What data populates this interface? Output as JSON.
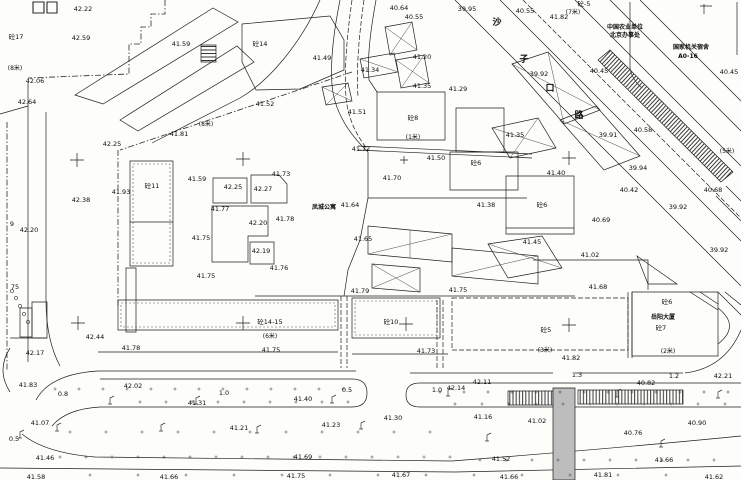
{
  "map": {
    "type": "topographic-site-plan",
    "colors": {
      "background": "#fdfdfa",
      "line": "#1e1e1e",
      "hatch": "#3a3a3a",
      "median_fill": "#bdbdbd"
    },
    "street_name_chars": [
      {
        "x": 497,
        "y": 25,
        "t": "沙"
      },
      {
        "x": 524,
        "y": 62,
        "t": "子"
      },
      {
        "x": 550,
        "y": 91,
        "t": "口"
      },
      {
        "x": 579,
        "y": 118,
        "t": "路"
      }
    ],
    "place_names": [
      {
        "x": 324,
        "y": 209,
        "t": "凤城公寓"
      },
      {
        "x": 663,
        "y": 319,
        "t": "岳阳大厦"
      },
      {
        "x": 625,
        "y": 29,
        "t": "中国农业单位"
      },
      {
        "x": 625,
        "y": 37,
        "t": "北京办事处"
      },
      {
        "x": 691,
        "y": 49,
        "t": "国家机关宿舍"
      },
      {
        "x": 688,
        "y": 58,
        "t": "A0-16"
      }
    ],
    "floor_labels": [
      {
        "x": 16,
        "y": 39,
        "t": "砼17"
      },
      {
        "x": 260,
        "y": 46,
        "t": "砼14"
      },
      {
        "x": 584,
        "y": 6,
        "t": "砼-5"
      },
      {
        "x": 152,
        "y": 188,
        "t": "砼11"
      },
      {
        "x": 413,
        "y": 120,
        "t": "砼8"
      },
      {
        "x": 476,
        "y": 165,
        "t": "砼6"
      },
      {
        "x": 542,
        "y": 207,
        "t": "砼6"
      },
      {
        "x": 667,
        "y": 304,
        "t": "砼6"
      },
      {
        "x": 270,
        "y": 324,
        "t": "砼14-15"
      },
      {
        "x": 391,
        "y": 324,
        "t": "砼10"
      },
      {
        "x": 546,
        "y": 332,
        "t": "砼5"
      },
      {
        "x": 661,
        "y": 330,
        "t": "砼7"
      }
    ],
    "road_widths": [
      {
        "x": 15,
        "y": 70,
        "t": "(8米)"
      },
      {
        "x": 206,
        "y": 126,
        "t": "(8米)"
      },
      {
        "x": 573,
        "y": 14,
        "t": "(7米)"
      },
      {
        "x": 413,
        "y": 139,
        "t": "(1米)"
      },
      {
        "x": 727,
        "y": 153,
        "t": "(5米)"
      },
      {
        "x": 270,
        "y": 338,
        "t": "(6米)"
      },
      {
        "x": 545,
        "y": 352,
        "t": "(3米)"
      },
      {
        "x": 668,
        "y": 353,
        "t": "(2米)"
      }
    ],
    "spot_elevations": [
      {
        "x": 83,
        "y": 11,
        "t": "42.22"
      },
      {
        "x": 81,
        "y": 40,
        "t": "42.59"
      },
      {
        "x": 35,
        "y": 83,
        "t": "42.06"
      },
      {
        "x": 27,
        "y": 104,
        "t": "42.64"
      },
      {
        "x": 181,
        "y": 46,
        "t": "41.59"
      },
      {
        "x": 265,
        "y": 106,
        "t": "41.52"
      },
      {
        "x": 322,
        "y": 60,
        "t": "41.49"
      },
      {
        "x": 357,
        "y": 114,
        "t": "41.51"
      },
      {
        "x": 370,
        "y": 72,
        "t": "41.34"
      },
      {
        "x": 422,
        "y": 59,
        "t": "41.20"
      },
      {
        "x": 399,
        "y": 10,
        "t": "40.64"
      },
      {
        "x": 414,
        "y": 19,
        "t": "40.55"
      },
      {
        "x": 467,
        "y": 11,
        "t": "39.95"
      },
      {
        "x": 422,
        "y": 88,
        "t": "41.35"
      },
      {
        "x": 458,
        "y": 91,
        "t": "41.29"
      },
      {
        "x": 525,
        "y": 13,
        "t": "40.55"
      },
      {
        "x": 559,
        "y": 19,
        "t": "41.82"
      },
      {
        "x": 539,
        "y": 76,
        "t": "39.92"
      },
      {
        "x": 599,
        "y": 73,
        "t": "40.45"
      },
      {
        "x": 729,
        "y": 74,
        "t": "40.45"
      },
      {
        "x": 112,
        "y": 146,
        "t": "42.25"
      },
      {
        "x": 179,
        "y": 136,
        "t": "41.81"
      },
      {
        "x": 121,
        "y": 194,
        "t": "41.93"
      },
      {
        "x": 197,
        "y": 181,
        "t": "41.59"
      },
      {
        "x": 81,
        "y": 202,
        "t": "42.38"
      },
      {
        "x": 233,
        "y": 189,
        "t": "42.25"
      },
      {
        "x": 263,
        "y": 191,
        "t": "42.27"
      },
      {
        "x": 281,
        "y": 176,
        "t": "41.73"
      },
      {
        "x": 220,
        "y": 211,
        "t": "41.77"
      },
      {
        "x": 258,
        "y": 225,
        "t": "42.20"
      },
      {
        "x": 285,
        "y": 221,
        "t": "41.78"
      },
      {
        "x": 201,
        "y": 240,
        "t": "41.75"
      },
      {
        "x": 261,
        "y": 253,
        "t": "42.19"
      },
      {
        "x": 279,
        "y": 270,
        "t": "41.76"
      },
      {
        "x": 206,
        "y": 278,
        "t": "41.75"
      },
      {
        "x": 29,
        "y": 232,
        "t": "42.20"
      },
      {
        "x": 12,
        "y": 226,
        "t": "9"
      },
      {
        "x": 15,
        "y": 289,
        "t": "75"
      },
      {
        "x": 35,
        "y": 355,
        "t": "42.17"
      },
      {
        "x": 95,
        "y": 339,
        "t": "42.44"
      },
      {
        "x": 131,
        "y": 350,
        "t": "41.78"
      },
      {
        "x": 361,
        "y": 151,
        "t": "41.72"
      },
      {
        "x": 436,
        "y": 160,
        "t": "41.50"
      },
      {
        "x": 392,
        "y": 180,
        "t": "41.70"
      },
      {
        "x": 350,
        "y": 207,
        "t": "41.64"
      },
      {
        "x": 363,
        "y": 241,
        "t": "41.65"
      },
      {
        "x": 486,
        "y": 207,
        "t": "41.38"
      },
      {
        "x": 515,
        "y": 137,
        "t": "41.35"
      },
      {
        "x": 608,
        "y": 137,
        "t": "39.91"
      },
      {
        "x": 643,
        "y": 132,
        "t": "40.58"
      },
      {
        "x": 638,
        "y": 170,
        "t": "39.94"
      },
      {
        "x": 556,
        "y": 175,
        "t": "41.40"
      },
      {
        "x": 629,
        "y": 192,
        "t": "40.42"
      },
      {
        "x": 713,
        "y": 192,
        "t": "40.68"
      },
      {
        "x": 678,
        "y": 209,
        "t": "39.92"
      },
      {
        "x": 601,
        "y": 222,
        "t": "40.69"
      },
      {
        "x": 532,
        "y": 244,
        "t": "41.45"
      },
      {
        "x": 590,
        "y": 257,
        "t": "41.02"
      },
      {
        "x": 598,
        "y": 289,
        "t": "41.68"
      },
      {
        "x": 719,
        "y": 252,
        "t": "39.92"
      },
      {
        "x": 571,
        "y": 360,
        "t": "41.82"
      },
      {
        "x": 271,
        "y": 352,
        "t": "41.75"
      },
      {
        "x": 426,
        "y": 353,
        "t": "41.73"
      },
      {
        "x": 360,
        "y": 293,
        "t": "41.79"
      },
      {
        "x": 458,
        "y": 292,
        "t": "41.75"
      },
      {
        "x": 28,
        "y": 387,
        "t": "41.83"
      },
      {
        "x": 63,
        "y": 396,
        "t": "0.8"
      },
      {
        "x": 133,
        "y": 388,
        "t": "42.02"
      },
      {
        "x": 224,
        "y": 395,
        "t": "1.0"
      },
      {
        "x": 197,
        "y": 405,
        "t": "41.31"
      },
      {
        "x": 40,
        "y": 425,
        "t": "41.07"
      },
      {
        "x": 239,
        "y": 430,
        "t": "41.21"
      },
      {
        "x": 14,
        "y": 441,
        "t": "0.5"
      },
      {
        "x": 45,
        "y": 460,
        "t": "41.46"
      },
      {
        "x": 36,
        "y": 479,
        "t": "41.58"
      },
      {
        "x": 169,
        "y": 479,
        "t": "41.66"
      },
      {
        "x": 347,
        "y": 392,
        "t": "0.5"
      },
      {
        "x": 303,
        "y": 401,
        "t": "41.40"
      },
      {
        "x": 437,
        "y": 392,
        "t": "1.0"
      },
      {
        "x": 456,
        "y": 390,
        "t": "42.14"
      },
      {
        "x": 482,
        "y": 384,
        "t": "42.11"
      },
      {
        "x": 393,
        "y": 420,
        "t": "41.30"
      },
      {
        "x": 483,
        "y": 419,
        "t": "41.16"
      },
      {
        "x": 331,
        "y": 427,
        "t": "41.23"
      },
      {
        "x": 303,
        "y": 459,
        "t": "41.69"
      },
      {
        "x": 296,
        "y": 478,
        "t": "41.75"
      },
      {
        "x": 401,
        "y": 477,
        "t": "41.67"
      },
      {
        "x": 577,
        "y": 377,
        "t": "1.3"
      },
      {
        "x": 674,
        "y": 378,
        "t": "1.2"
      },
      {
        "x": 723,
        "y": 378,
        "t": "42.21"
      },
      {
        "x": 646,
        "y": 385,
        "t": "40.82"
      },
      {
        "x": 537,
        "y": 423,
        "t": "41.02"
      },
      {
        "x": 697,
        "y": 425,
        "t": "40.90"
      },
      {
        "x": 633,
        "y": 435,
        "t": "40.76"
      },
      {
        "x": 501,
        "y": 461,
        "t": "41.52"
      },
      {
        "x": 664,
        "y": 462,
        "t": "41.66"
      },
      {
        "x": 603,
        "y": 477,
        "t": "41.81"
      },
      {
        "x": 509,
        "y": 479,
        "t": "41.66"
      },
      {
        "x": 714,
        "y": 479,
        "t": "41.62"
      }
    ],
    "survey_crosses": [
      [
        77,
        160
      ],
      [
        243,
        159
      ],
      [
        569,
        158
      ],
      [
        78,
        323
      ],
      [
        243,
        323
      ],
      [
        406,
        324
      ],
      [
        569,
        325
      ]
    ],
    "street_lamps": [
      [
        110,
        404
      ],
      [
        196,
        404
      ],
      [
        332,
        403
      ],
      [
        448,
        396
      ],
      [
        617,
        397
      ],
      [
        718,
        398
      ],
      [
        57,
        431
      ],
      [
        161,
        431
      ],
      [
        257,
        433
      ],
      [
        361,
        429
      ],
      [
        487,
        441
      ],
      [
        661,
        447
      ],
      [
        20,
        438
      ]
    ],
    "texture_dot_rows": [
      {
        "y": 389,
        "x0": 55,
        "x1": 345,
        "step": 24
      },
      {
        "y": 402,
        "x0": 140,
        "x1": 352,
        "step": 26
      },
      {
        "y": 392,
        "x0": 440,
        "x1": 738,
        "step": 24
      },
      {
        "y": 404,
        "x0": 455,
        "x1": 735,
        "step": 27
      },
      {
        "y": 432,
        "x0": 70,
        "x1": 460,
        "step": 36
      },
      {
        "y": 457,
        "x0": 60,
        "x1": 460,
        "step": 26
      },
      {
        "y": 460,
        "x0": 480,
        "x1": 738,
        "step": 26
      },
      {
        "y": 475,
        "x0": 90,
        "x1": 700,
        "step": 48
      }
    ],
    "pole_circles": [
      [
        12,
        291
      ],
      [
        16,
        298
      ],
      [
        20,
        306
      ],
      [
        24,
        314
      ],
      [
        28,
        322
      ]
    ]
  }
}
